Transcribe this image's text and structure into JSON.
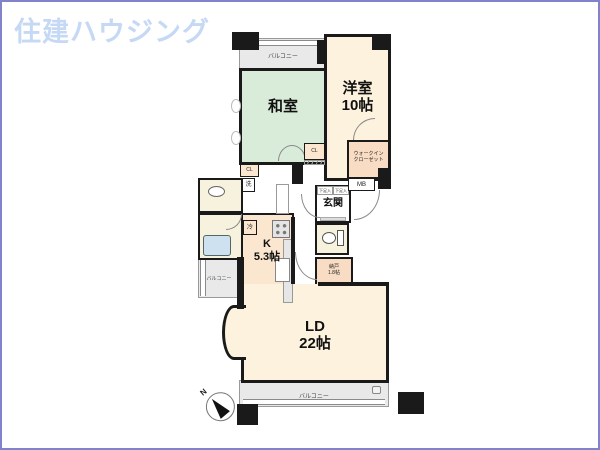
{
  "logo": {
    "text": "住建ハウジング"
  },
  "colors": {
    "frame": "#8181cc",
    "logo_text": "#c5d9f5",
    "wall": "#1a1a1a",
    "tatami_room": "#d9ecd9",
    "western_room": "#fdf2dd",
    "kitchen": "#fbe7d0",
    "storage": "#f8dcc3",
    "sanitary": "#f6f2de",
    "balcony": "#e9e9e9",
    "bathtub": "#cde1f0"
  },
  "floorplan": {
    "compass": {
      "label": "N"
    },
    "rooms": {
      "washitsu": {
        "name": "和室"
      },
      "yoshitsu": {
        "name": "洋室",
        "size": "10帖"
      },
      "kitchen": {
        "name": "K",
        "size": "5.3帖"
      },
      "living_dining": {
        "name": "LD",
        "size": "22帖"
      },
      "genkan": {
        "name": "玄関"
      },
      "walk_in_closet": {
        "name_line1": "ウォークイン",
        "name_line2": "クローゼット"
      },
      "nando": {
        "name": "納戸",
        "size": "1.8帖"
      },
      "balcony_top": {
        "name": "バルコニー"
      },
      "balcony_left": {
        "name": "バルコニー"
      },
      "balcony_bottom": {
        "name": "バルコニー"
      }
    },
    "labels": {
      "meter_box": "MB",
      "closet_1": "CL",
      "closet_2": "CL",
      "fridge": "冷",
      "washer": "洗",
      "shoe_box_1": "下足入",
      "shoe_box_2": "下足入"
    }
  }
}
